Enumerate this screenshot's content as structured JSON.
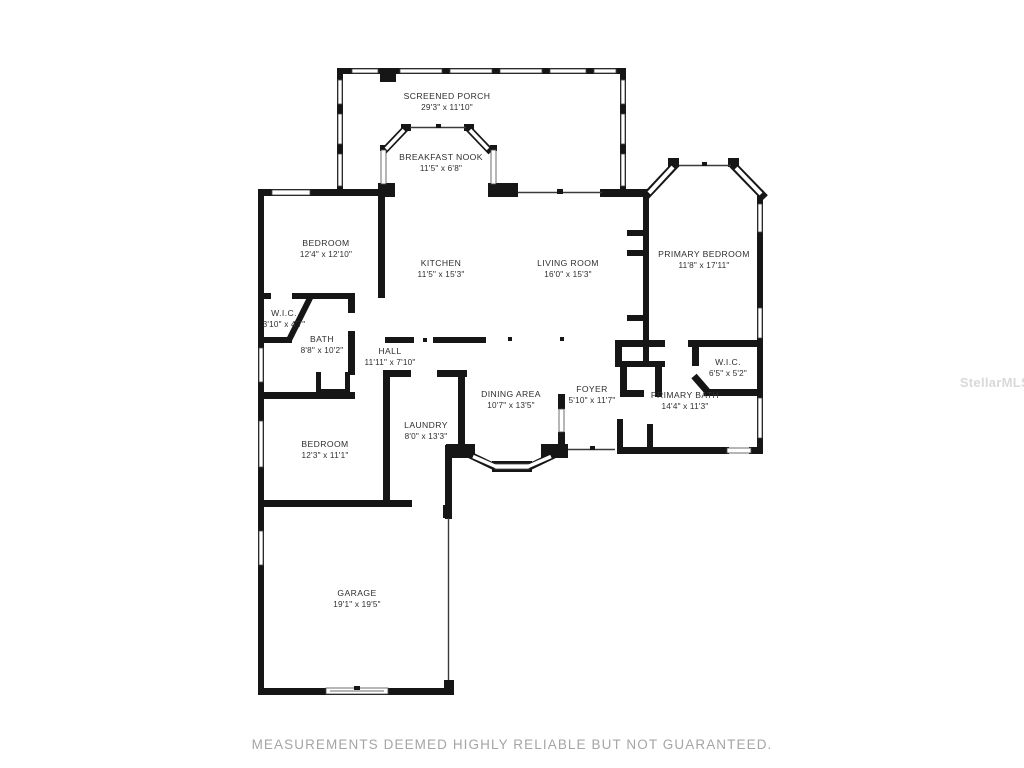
{
  "page": {
    "watermark": "StellarMLS",
    "footer": "MEASUREMENTS DEEMED HIGHLY RELIABLE BUT NOT GUARANTEED."
  },
  "colors": {
    "wall": "#161616",
    "window_outline": "#444444",
    "label_text": "#2e2e2e",
    "footer_text": "#a5a5a5",
    "watermark_text": "#d9d9d9"
  },
  "rooms": [
    {
      "name": "SCREENED PORCH",
      "dims": "29'3\" x 11'10\""
    },
    {
      "name": "BREAKFAST NOOK",
      "dims": "11'5\" x 6'8\""
    },
    {
      "name": "BEDROOM",
      "dims": "12'4\" x 12'10\""
    },
    {
      "name": "KITCHEN",
      "dims": "11'5\" x 15'3\""
    },
    {
      "name": "LIVING ROOM",
      "dims": "16'0\" x 15'3\""
    },
    {
      "name": "PRIMARY BEDROOM",
      "dims": "11'8\" x 17'11\""
    },
    {
      "name": "W.I.C.",
      "dims": "3'10\" x 4'7\""
    },
    {
      "name": "BATH",
      "dims": "8'8\" x 10'2\""
    },
    {
      "name": "HALL",
      "dims": "11'11\" x 7'10\""
    },
    {
      "name": "DINING AREA",
      "dims": "10'7\" x 13'5\""
    },
    {
      "name": "FOYER",
      "dims": "5'10\" x 11'7\""
    },
    {
      "name": "W.I.C.",
      "dims": "6'5\" x 5'2\""
    },
    {
      "name": "PRIMARY BATH",
      "dims": "14'4\" x 11'3\""
    },
    {
      "name": "BEDROOM",
      "dims": "12'3\" x 11'1\""
    },
    {
      "name": "LAUNDRY",
      "dims": "8'0\" x 13'3\""
    },
    {
      "name": "GARAGE",
      "dims": "19'1\" x 19'5\""
    }
  ]
}
